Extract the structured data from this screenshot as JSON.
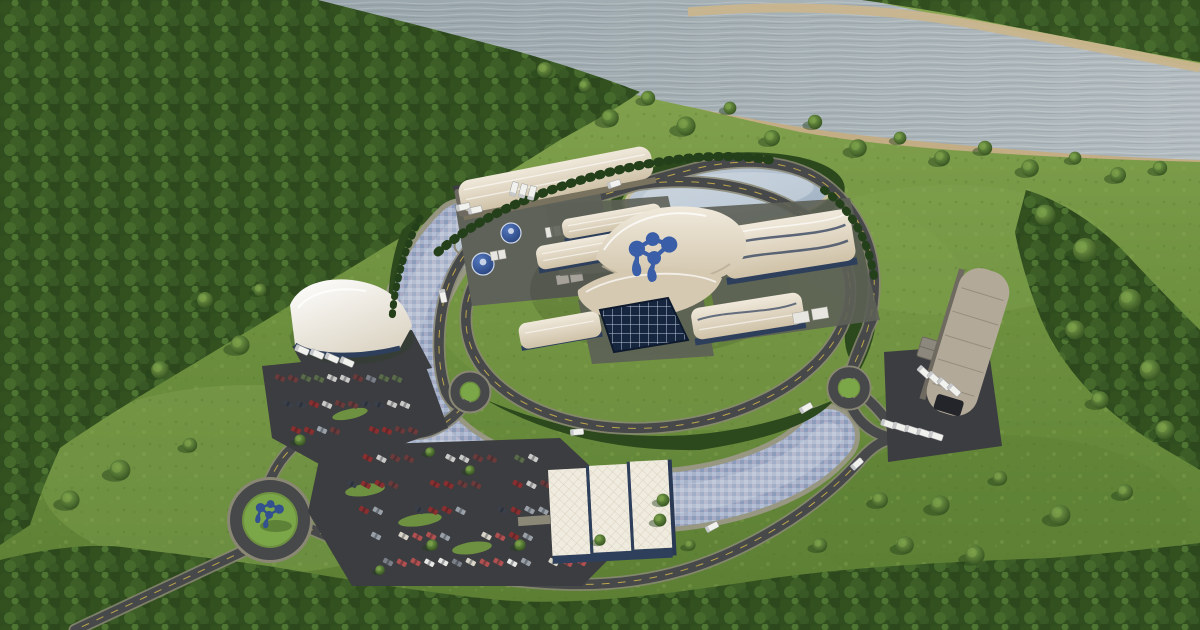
{
  "scene": {
    "title": "Aerial rendering of a riverside small modular reactor power plant campus",
    "description": "Bird's-eye 3D rendering: an oval landscaped campus with a central reactor complex under flowing cream canopy roofs bearing a blue droplet-molecule emblem, a crescent blue-tiled cooling canal, ring roads with roundabouts, parking lots full of cars, warehouses with truck docks, dense forest and a wide gray-blue river along the top"
  },
  "branding": {
    "roof_emblem": "blue droplet-molecule emblem on main canopy roof",
    "roundabout_sculpture": "blue emblem sculpture in entrance roundabout"
  },
  "colors": {
    "grass_light": "#8aa854",
    "grass_mid": "#6f9240",
    "grass_dark": "#5a7d33",
    "lawn": "#7ba04a",
    "forest_base": "#2f4d1e",
    "hedge": "#2c481d",
    "hedge_dark": "#24401a",
    "river_near": "#98a5ab",
    "river_far": "#b3bcc0",
    "shore_rock": "#c6b28b",
    "road": "#46484a",
    "road_shoulder": "#8a8874",
    "road_line": "#d4b74a",
    "asphalt": "#3c3d40",
    "canal_rim": "#9a9886",
    "canal": "#9dafc9",
    "pond_light": "#c3cdd8",
    "pond": "#9fb0c2",
    "roof_light": "#f0e9db",
    "roof_cream": "#cfc2a8",
    "roof_front": "#d5c9b2",
    "wall_blue": "#2e3f5c",
    "glass_navy": "#17263f",
    "concrete": "#5f6259",
    "warehouse_gray": "#b3a999",
    "logo_blue": "#3b5ea8",
    "logo_dark_blue": "#33508f",
    "tank_blue": "#27427c",
    "vehicle_white": "#f1f1ee"
  },
  "vehicles": {
    "car_colors": [
      "#e8e8e6",
      "#c9c9c7",
      "#8a2f2f",
      "#b05050",
      "#5a6b4a",
      "#3a3f4a",
      "#d9d4c8",
      "#7a7f88",
      "#6b3b3b",
      "#9aa0a8"
    ],
    "parking_lots": [
      {
        "name": "west-lot",
        "x": 280,
        "y": 378,
        "rows": 3,
        "cols": 10,
        "dx": 13,
        "dy": 26,
        "rowShiftX": 8,
        "carAngle": 24,
        "fill": 0.86
      },
      {
        "name": "south-lot",
        "x": 340,
        "y": 458,
        "rows": 5,
        "cols": 15,
        "dx": 13.8,
        "dy": 26,
        "rowShiftX": 12,
        "carAngle": 28,
        "fill": 0.8
      }
    ],
    "truck_groups": [
      {
        "name": "canopy-dock-trucks",
        "x": 302,
        "y": 350,
        "n": 4,
        "dx": 15,
        "dy": 4,
        "angle": 24
      },
      {
        "name": "north-apron-trucks",
        "x": 463,
        "y": 207,
        "n": 2,
        "dx": 12,
        "dy": 3,
        "angle": -12
      },
      {
        "name": "north-dock-trucks",
        "x": 514,
        "y": 189,
        "n": 3,
        "dx": 9,
        "dy": 2,
        "angle": -75
      },
      {
        "name": "depot-row-trucks",
        "x": 888,
        "y": 424,
        "n": 5,
        "dx": 12,
        "dy": 3,
        "angle": 18
      },
      {
        "name": "depot-angled-trucks",
        "x": 924,
        "y": 372,
        "n": 4,
        "dx": 10,
        "dy": 6,
        "angle": 42
      }
    ],
    "road_trucks": [
      [
        443,
        296,
        78
      ],
      [
        577,
        432,
        -5
      ],
      [
        712,
        527,
        -28
      ],
      [
        806,
        408,
        -30
      ],
      [
        614,
        184,
        -18
      ],
      [
        857,
        464,
        -42
      ]
    ]
  },
  "vegetation": {
    "scattered_trees": [
      [
        610,
        118,
        1.1
      ],
      [
        648,
        98,
        0.9
      ],
      [
        686,
        126,
        1.2
      ],
      [
        730,
        108,
        0.8
      ],
      [
        772,
        138,
        1.0
      ],
      [
        815,
        122,
        0.9
      ],
      [
        858,
        148,
        1.1
      ],
      [
        900,
        138,
        0.8
      ],
      [
        942,
        158,
        1.0
      ],
      [
        985,
        148,
        0.9
      ],
      [
        1030,
        168,
        1.1
      ],
      [
        1075,
        158,
        0.8
      ],
      [
        1118,
        175,
        1.0
      ],
      [
        1160,
        168,
        0.9
      ],
      [
        585,
        86,
        0.8
      ],
      [
        545,
        70,
        1.0
      ],
      [
        1045,
        215,
        1.3
      ],
      [
        1085,
        250,
        1.5
      ],
      [
        1130,
        300,
        1.4
      ],
      [
        1075,
        330,
        1.2
      ],
      [
        1150,
        370,
        1.3
      ],
      [
        1100,
        400,
        1.1
      ],
      [
        1165,
        430,
        1.2
      ],
      [
        940,
        505,
        1.2
      ],
      [
        1000,
        478,
        0.9
      ],
      [
        1060,
        515,
        1.3
      ],
      [
        1125,
        492,
        1.0
      ],
      [
        905,
        545,
        1.1
      ],
      [
        975,
        555,
        1.2
      ],
      [
        880,
        500,
        1.0
      ],
      [
        820,
        545,
        0.9
      ],
      [
        240,
        345,
        1.2
      ],
      [
        205,
        300,
        1.0
      ],
      [
        160,
        370,
        1.1
      ],
      [
        120,
        470,
        1.3
      ],
      [
        190,
        445,
        0.9
      ],
      [
        70,
        500,
        1.2
      ],
      [
        260,
        290,
        0.8
      ],
      [
        300,
        440,
        0.7
      ],
      [
        430,
        452,
        0.6
      ],
      [
        470,
        470,
        0.6
      ],
      [
        520,
        545,
        0.7
      ],
      [
        600,
        540,
        0.7
      ],
      [
        660,
        520,
        0.8
      ],
      [
        432,
        545,
        0.7
      ],
      [
        380,
        570,
        0.6
      ],
      [
        663,
        500,
        0.8
      ],
      [
        690,
        545,
        0.7
      ]
    ]
  }
}
